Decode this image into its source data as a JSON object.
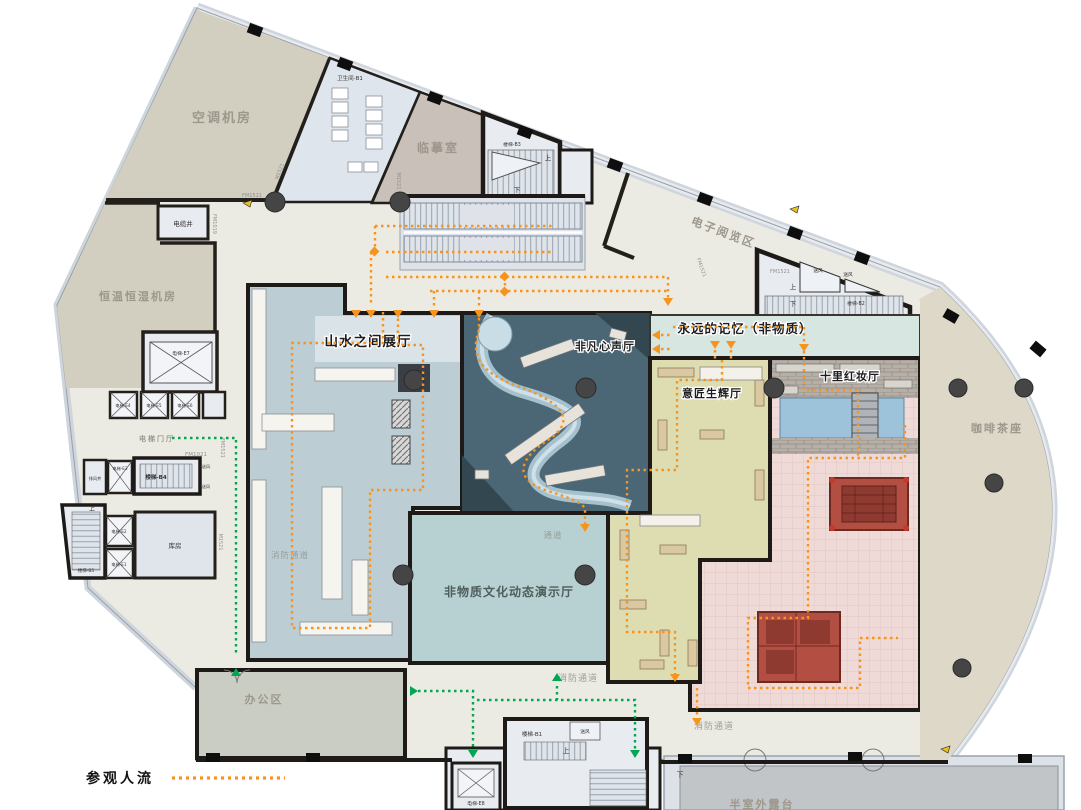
{
  "title": "museum-floor-plan",
  "legend": {
    "visitor_flow": "参观人流"
  },
  "halls": {
    "shanshui": "山水之间展厅",
    "feifan": "非凡心声厅",
    "memory": "永远的记忆（非物质）",
    "yijiang": "意匠生辉厅",
    "shili": "十里红妆厅",
    "demo": "非物质文化动态演示厅",
    "coffee": "咖啡茶座",
    "reading": "电子阅览区",
    "copy": "临摹室"
  },
  "service": {
    "ac": "空调机房",
    "hvac": "恒温恒湿机房",
    "toilet": "卫生间-B1",
    "cable": "电缆井",
    "exhaust": "排风井",
    "lobby": "电梯门厅",
    "storage": "库房",
    "office": "办公区",
    "terrace": "半室外露台",
    "passage": "通道",
    "fire": "消防通道"
  },
  "stairs": {
    "b1": "楼梯-B1",
    "b2": "楼梯-B2",
    "b3": "楼梯-B3",
    "b4": "楼梯-B4",
    "b5": "楼梯-B5"
  },
  "elevators": {
    "e1": "电梯-E1",
    "e2": "电梯-E2",
    "e3": "电梯-E3",
    "e4": "电梯-E4",
    "e5": "电梯-E5",
    "e6": "电梯-E6",
    "e7": "电梯-E7",
    "e8": "电梯-E8"
  },
  "doors": {
    "fm1521": "FM1521",
    "fm1021": "FM1021",
    "fm1019": "FM1019",
    "m1521": "M1521"
  },
  "marks": {
    "up": "上",
    "down": "下",
    "air": "送风"
  },
  "colors": {
    "flow_orange": "#F7941D",
    "flow_green": "#00A651",
    "wall": "#23201c",
    "floor": "#ecebe3",
    "shanshui_fill": "#bccdd3",
    "feifan_fill": "#4b6674",
    "yijiang_fill": "#deddb2",
    "shili_fill": "#f0dad7",
    "demo_fill": "#b7d0d2",
    "memory_fill": "#d7e6e1",
    "coffee_fill": "#ddd8c8",
    "machine_fill": "#d2cfc1",
    "office_fill": "#c9cdc3",
    "water_fill": "#9cc3da"
  }
}
